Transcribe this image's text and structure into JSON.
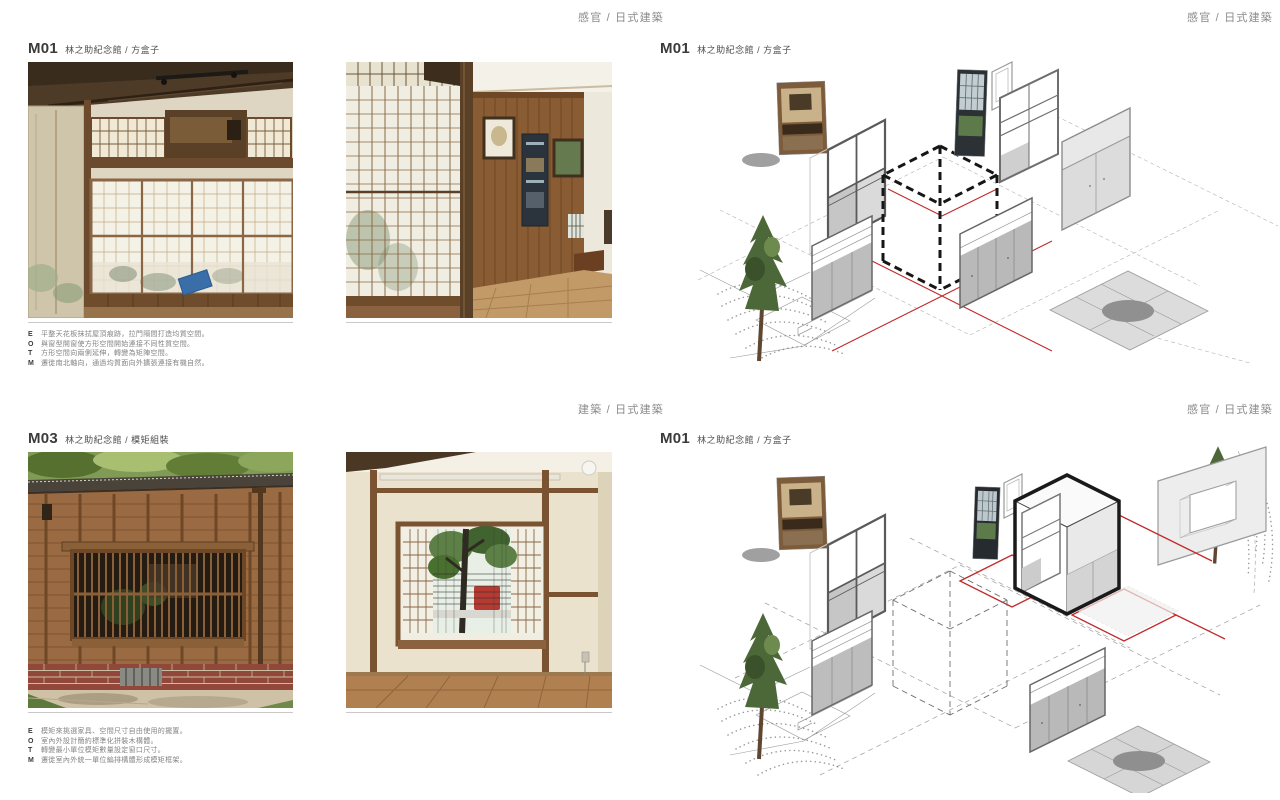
{
  "headers": {
    "top_left_page": "感官 / 日式建築",
    "top_right_page": "感官 / 日式建築",
    "bottom_left_page": "建築 / 日式建築",
    "bottom_right_page": "感官 / 日式建築"
  },
  "spread_top": {
    "photo_page": {
      "code": "M01",
      "subtitle": "林之助紀念館 / 方盒子",
      "photos": [
        "japanese-room-shoji-window",
        "japanese-corridor-wood-wall"
      ],
      "notes": [
        {
          "key": "E",
          "text": "平整天花板抹拭屋頂痕跡，拉門隔間打造均質空間。"
        },
        {
          "key": "O",
          "text": "與窗型開窗使方形空間開始連接不同性質空間。"
        },
        {
          "key": "T",
          "text": "方形空間向兩側延伸，轉變為矩陣空間。"
        },
        {
          "key": "M",
          "text": "遷徙南北軸向，通過均質面向外擴張連接有機自然。"
        }
      ]
    },
    "diagram_page": {
      "code": "M01",
      "subtitle": "林之助紀念館 / 方盒子",
      "diagram": "exploded-isometric-dashed-cube"
    }
  },
  "spread_bottom": {
    "photo_page": {
      "code": "M03",
      "subtitle": "林之助紀念館 / 模矩組裝",
      "photos": [
        "wooden-facade-lattice-window",
        "interior-lattice-window-room"
      ],
      "notes": [
        {
          "key": "E",
          "text": "模矩來挑選家具、空間尺寸自由使用的擺置。"
        },
        {
          "key": "O",
          "text": "室內外設計簡約標準化拼裝木構體。"
        },
        {
          "key": "T",
          "text": "轉變最小單位模矩數量設定窗口尺寸。"
        },
        {
          "key": "M",
          "text": "遷徙室內外統一單位編排構體形成模矩框架。"
        }
      ]
    },
    "diagram_page": {
      "code": "M01",
      "subtitle": "林之助紀念館 / 方盒子",
      "diagram": "exploded-isometric-solid-cube"
    }
  },
  "colors": {
    "header_text": "#8a8a8a",
    "title_text": "#3b3b3b",
    "note_text": "#848484",
    "rule": "#c9c9c9",
    "diagram_red": "#c22a2a",
    "diagram_black": "#161616"
  }
}
